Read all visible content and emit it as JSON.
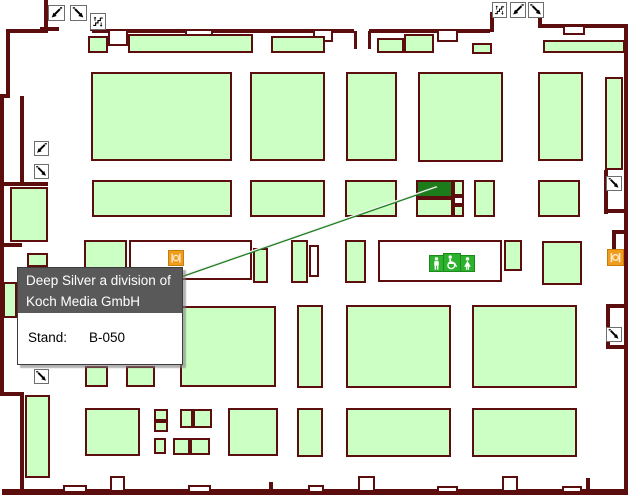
{
  "tooltip": {
    "title_line1": "Deep Silver a division of",
    "title_line2": "Koch Media GmbH",
    "stand_label": "Stand:",
    "stand_value": "B-050"
  },
  "colors": {
    "wall": "#5c0d0d",
    "booth_fill": "#ccffc4",
    "booth_highlight": "#1c7c1c",
    "leader_line": "#1e7e1e",
    "tooltip_header": "#595959",
    "wc_icon": "#2db22d",
    "restaurant_icon": "#f09c1e"
  },
  "map": {
    "walls": [
      [
        44,
        0,
        4,
        33
      ],
      [
        6,
        29,
        42,
        4
      ],
      [
        6,
        29,
        4,
        67
      ],
      [
        0,
        94,
        10,
        4
      ],
      [
        0,
        94,
        4,
        302
      ],
      [
        2,
        392,
        22,
        4
      ],
      [
        20,
        394,
        4,
        98
      ],
      [
        2,
        489,
        626,
        6
      ],
      [
        40,
        27,
        19,
        4
      ],
      [
        90,
        13,
        4,
        18
      ],
      [
        92,
        29,
        262,
        4
      ],
      [
        354,
        31,
        3,
        18
      ],
      [
        368,
        31,
        3,
        18
      ],
      [
        369,
        29,
        121,
        4
      ],
      [
        490,
        12,
        4,
        20
      ],
      [
        538,
        12,
        4,
        14
      ],
      [
        538,
        24,
        90,
        4
      ],
      [
        624,
        27,
        4,
        466
      ],
      [
        604,
        170,
        4,
        44
      ],
      [
        604,
        209,
        24,
        4
      ],
      [
        612,
        230,
        4,
        36
      ],
      [
        612,
        230,
        14,
        4
      ],
      [
        612,
        262,
        14,
        4
      ],
      [
        606,
        304,
        4,
        44
      ],
      [
        606,
        304,
        20,
        4
      ],
      [
        606,
        345,
        22,
        4
      ],
      [
        0,
        182,
        48,
        4
      ],
      [
        20,
        96,
        4,
        86
      ],
      [
        0,
        243,
        22,
        4
      ]
    ],
    "openings": [
      [
        108,
        29,
        20,
        17
      ],
      [
        185,
        29,
        28,
        10
      ],
      [
        313,
        29,
        20,
        13
      ],
      [
        437,
        29,
        21,
        13
      ],
      [
        563,
        25,
        22,
        10
      ],
      [
        63,
        485,
        24,
        8
      ],
      [
        110,
        476,
        15,
        16
      ],
      [
        188,
        485,
        23,
        8
      ],
      [
        269,
        482,
        4,
        10
      ],
      [
        308,
        485,
        16,
        8
      ],
      [
        358,
        476,
        17,
        16
      ],
      [
        437,
        486,
        21,
        7
      ],
      [
        502,
        476,
        16,
        16
      ],
      [
        562,
        486,
        20,
        7
      ],
      [
        586,
        478,
        4,
        12
      ]
    ],
    "booths": [
      {
        "r": [
          88,
          36,
          20,
          17
        ],
        "v": "green"
      },
      {
        "r": [
          128,
          34,
          125,
          19
        ],
        "v": "green"
      },
      {
        "r": [
          271,
          36,
          54,
          17
        ],
        "v": "green"
      },
      {
        "r": [
          377,
          38,
          27,
          15
        ],
        "v": "green"
      },
      {
        "r": [
          404,
          34,
          30,
          19
        ],
        "v": "green"
      },
      {
        "r": [
          472,
          43,
          20,
          11
        ],
        "v": "green"
      },
      {
        "r": [
          543,
          40,
          82,
          13
        ],
        "v": "green"
      },
      {
        "r": [
          91,
          72,
          141,
          89
        ],
        "v": "green"
      },
      {
        "r": [
          250,
          72,
          75,
          89
        ],
        "v": "green"
      },
      {
        "r": [
          346,
          72,
          51,
          89
        ],
        "v": "green"
      },
      {
        "r": [
          418,
          72,
          85,
          90
        ],
        "v": "green"
      },
      {
        "r": [
          538,
          72,
          45,
          89
        ],
        "v": "green"
      },
      {
        "r": [
          605,
          77,
          18,
          93
        ],
        "v": "green"
      },
      {
        "r": [
          92,
          180,
          140,
          37
        ],
        "v": "green"
      },
      {
        "r": [
          250,
          180,
          75,
          37
        ],
        "v": "green"
      },
      {
        "r": [
          345,
          180,
          52,
          37
        ],
        "v": "green"
      },
      {
        "r": [
          474,
          180,
          21,
          37
        ],
        "v": "green"
      },
      {
        "r": [
          538,
          180,
          42,
          37
        ],
        "v": "green"
      },
      {
        "r": [
          416,
          180,
          37,
          18
        ],
        "v": "highlight"
      },
      {
        "r": [
          416,
          198,
          37,
          19
        ],
        "v": "green"
      },
      {
        "r": [
          453,
          180,
          11,
          16
        ],
        "v": "green"
      },
      {
        "r": [
          453,
          196,
          11,
          9
        ],
        "v": "outline"
      },
      {
        "r": [
          453,
          205,
          11,
          12
        ],
        "v": "green"
      },
      {
        "r": [
          10,
          187,
          38,
          55
        ],
        "v": "green"
      },
      {
        "r": [
          27,
          253,
          21,
          14
        ],
        "v": "green"
      },
      {
        "r": [
          3,
          282,
          14,
          36
        ],
        "v": "green"
      },
      {
        "r": [
          84,
          240,
          43,
          40
        ],
        "v": "green"
      },
      {
        "r": [
          129,
          240,
          123,
          40
        ],
        "v": "outline"
      },
      {
        "r": [
          253,
          248,
          15,
          35
        ],
        "v": "green"
      },
      {
        "r": [
          291,
          240,
          17,
          43
        ],
        "v": "green"
      },
      {
        "r": [
          309,
          245,
          10,
          32
        ],
        "v": "outline"
      },
      {
        "r": [
          345,
          240,
          21,
          43
        ],
        "v": "green"
      },
      {
        "r": [
          378,
          240,
          124,
          42
        ],
        "v": "outline"
      },
      {
        "r": [
          504,
          240,
          18,
          31
        ],
        "v": "green"
      },
      {
        "r": [
          542,
          241,
          40,
          44
        ],
        "v": "green"
      },
      {
        "r": [
          180,
          306,
          96,
          81
        ],
        "v": "green"
      },
      {
        "r": [
          297,
          305,
          26,
          83
        ],
        "v": "green"
      },
      {
        "r": [
          346,
          305,
          105,
          83
        ],
        "v": "green"
      },
      {
        "r": [
          472,
          305,
          105,
          83
        ],
        "v": "green"
      },
      {
        "r": [
          85,
          366,
          23,
          21
        ],
        "v": "green"
      },
      {
        "r": [
          126,
          366,
          29,
          21
        ],
        "v": "green"
      },
      {
        "r": [
          25,
          395,
          25,
          83
        ],
        "v": "green"
      },
      {
        "r": [
          85,
          408,
          55,
          48
        ],
        "v": "green"
      },
      {
        "r": [
          154,
          409,
          14,
          12
        ],
        "v": "green"
      },
      {
        "r": [
          154,
          421,
          14,
          11
        ],
        "v": "green"
      },
      {
        "r": [
          154,
          438,
          12,
          16
        ],
        "v": "green"
      },
      {
        "r": [
          180,
          409,
          13,
          19
        ],
        "v": "green"
      },
      {
        "r": [
          193,
          409,
          19,
          19
        ],
        "v": "green"
      },
      {
        "r": [
          173,
          438,
          17,
          17
        ],
        "v": "green"
      },
      {
        "r": [
          190,
          438,
          20,
          17
        ],
        "v": "green"
      },
      {
        "r": [
          228,
          408,
          50,
          48
        ],
        "v": "green"
      },
      {
        "r": [
          297,
          408,
          26,
          49
        ],
        "v": "green"
      },
      {
        "r": [
          346,
          408,
          105,
          49
        ],
        "v": "green"
      },
      {
        "r": [
          472,
          408,
          105,
          49
        ],
        "v": "green"
      }
    ],
    "icons": [
      {
        "type": "escalator-down",
        "x": 48,
        "y": 5,
        "w": 17,
        "h": 16
      },
      {
        "type": "escalator-up",
        "x": 70,
        "y": 5,
        "w": 17,
        "h": 16
      },
      {
        "type": "stairs",
        "x": 90,
        "y": 13,
        "w": 16,
        "h": 17
      },
      {
        "type": "stairs",
        "x": 492,
        "y": 2,
        "w": 15,
        "h": 16
      },
      {
        "type": "escalator-down",
        "x": 510,
        "y": 2,
        "w": 16,
        "h": 16
      },
      {
        "type": "escalator-up",
        "x": 528,
        "y": 2,
        "w": 16,
        "h": 16
      },
      {
        "type": "escalator-down",
        "x": 34,
        "y": 141,
        "w": 15,
        "h": 15
      },
      {
        "type": "escalator-up",
        "x": 34,
        "y": 164,
        "w": 15,
        "h": 15
      },
      {
        "type": "escalator-up",
        "x": 34,
        "y": 369,
        "w": 15,
        "h": 15
      },
      {
        "type": "escalator-up",
        "x": 606,
        "y": 176,
        "w": 16,
        "h": 15
      },
      {
        "type": "escalator-up",
        "x": 606,
        "y": 327,
        "w": 16,
        "h": 15
      },
      {
        "type": "restaurant",
        "x": 168,
        "y": 250,
        "w": 16,
        "h": 16
      },
      {
        "type": "restaurant",
        "x": 607,
        "y": 249,
        "w": 17,
        "h": 17
      },
      {
        "type": "wc-men",
        "x": 429,
        "y": 255,
        "w": 15,
        "h": 17
      },
      {
        "type": "wc-accessible",
        "x": 443,
        "y": 253,
        "w": 18,
        "h": 19
      },
      {
        "type": "wc-women",
        "x": 460,
        "y": 255,
        "w": 15,
        "h": 17
      }
    ],
    "leader_line": {
      "x1": 181,
      "y1": 277,
      "x2": 437,
      "y2": 188
    }
  }
}
